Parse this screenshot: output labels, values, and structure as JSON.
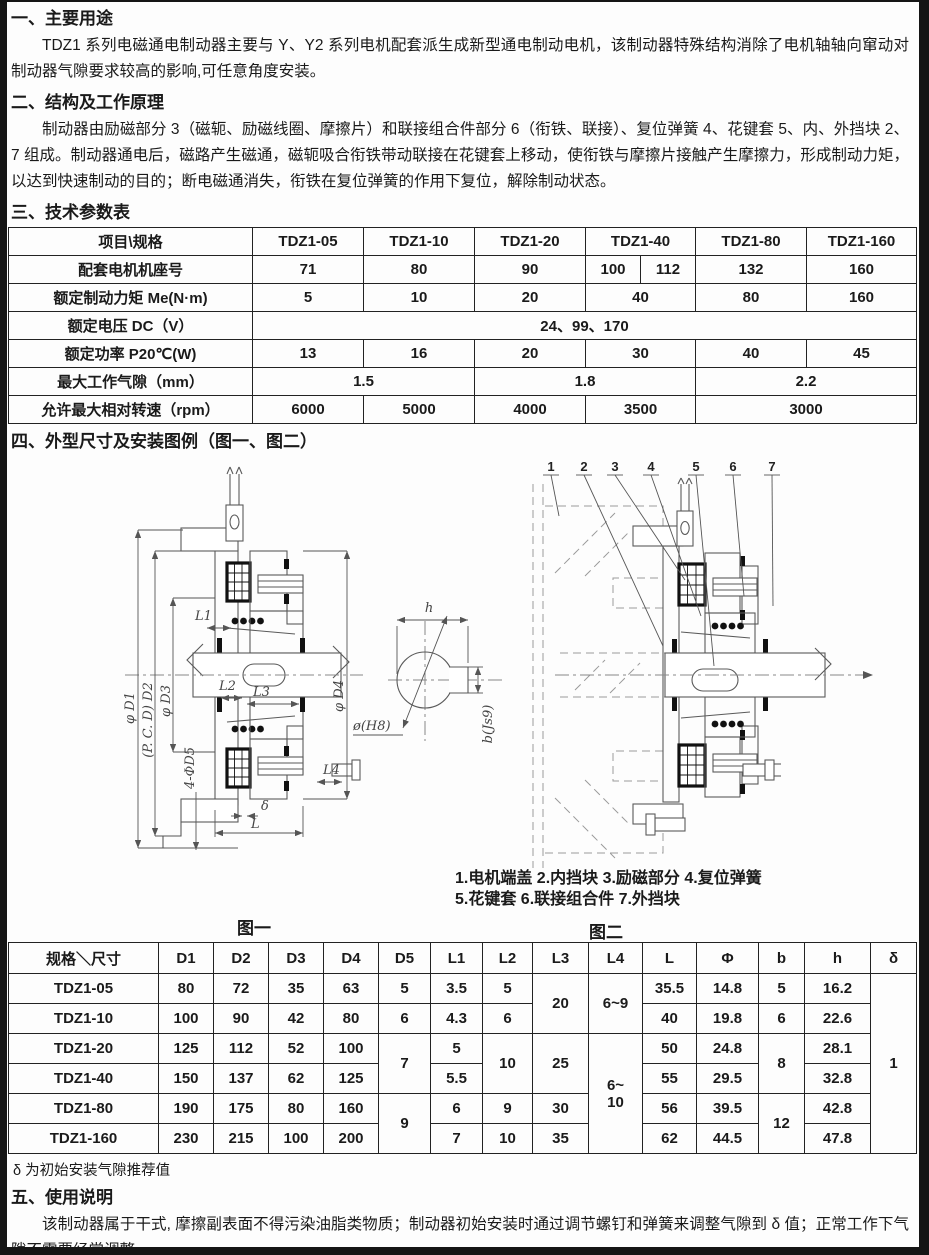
{
  "doc": {
    "s1": {
      "heading": "一、主要用途",
      "body": "TDZ1 系列电磁通电制动器主要与 Y、Y2 系列电机配套派生成新型通电制动电机，该制动器特殊结构消除了电机轴轴向窜动对制动器气隙要求较高的影响,可任意角度安装。"
    },
    "s2": {
      "heading": "二、结构及工作原理",
      "body": "制动器由励磁部分 3（磁轭、励磁线圈、摩擦片）和联接组合件部分 6（衔铁、联接）、复位弹簧 4、花键套 5、内、外挡块 2、7 组成。制动器通电后，磁路产生磁通，磁轭吸合衔铁带动联接在花键套上移动，使衔铁与摩擦片接触产生摩擦力，形成制动力矩，以达到快速制动的目的；断电磁通消失，衔铁在复位弹簧的作用下复位，解除制动状态。"
    },
    "s3": {
      "heading": "三、技术参数表"
    },
    "s4": {
      "heading": "四、外型尺寸及安装图例（图一、图二）"
    },
    "s5": {
      "heading": "五、使用说明",
      "body": "该制动器属于干式, 摩擦副表面不得污染油脂类物质；制动器初始安装时通过调节螺钉和弹簧来调整气隙到 δ 值；正常工作下气隙不需要经常调整。"
    },
    "footnote": "δ 为初始安装气隙推荐值"
  },
  "params_table": {
    "header": {
      "label": "项目\\规格",
      "cols": [
        "TDZ1-05",
        "TDZ1-10",
        "TDZ1-20",
        "TDZ1-40",
        "TDZ1-80",
        "TDZ1-160"
      ]
    },
    "motor_frame": {
      "label": "配套电机机座号",
      "values": [
        "71",
        "80",
        "90",
        "100",
        "112",
        "132",
        "160"
      ]
    },
    "torque": {
      "label": "额定制动力矩 Me(N·m)",
      "values": [
        "5",
        "10",
        "20",
        "40",
        "80",
        "160"
      ]
    },
    "voltage": {
      "label": "额定电压 DC（V）",
      "value": "24、99、170"
    },
    "power": {
      "label": "额定功率 P20℃(W)",
      "values": [
        "13",
        "16",
        "20",
        "30",
        "40",
        "45"
      ]
    },
    "gap": {
      "label": "最大工作气隙（mm）",
      "values": [
        "1.5",
        "1.8",
        "2.2"
      ]
    },
    "speed": {
      "label": "允许最大相对转速（rpm）",
      "values": [
        "6000",
        "5000",
        "4000",
        "3500",
        "3000"
      ]
    }
  },
  "dims_table": {
    "header": [
      "规格＼尺寸",
      "D1",
      "D2",
      "D3",
      "D4",
      "D5",
      "L1",
      "L2",
      "L3",
      "L4",
      "L",
      "Φ",
      "b",
      "h",
      "δ"
    ],
    "rows": [
      {
        "model": "TDZ1-05",
        "d1": "80",
        "d2": "72",
        "d3": "35",
        "d4": "63",
        "d5": "5",
        "l1": "3.5",
        "l2": "5",
        "l3": "20",
        "l4": "6~9",
        "l": "35.5",
        "phi": "14.8",
        "b": "5",
        "h": "16.2",
        "delta": "1"
      },
      {
        "model": "TDZ1-10",
        "d1": "100",
        "d2": "90",
        "d3": "42",
        "d4": "80",
        "d5": "6",
        "l1": "4.3",
        "l2": "6",
        "l": "40",
        "phi": "19.8",
        "b": "6",
        "h": "22.6"
      },
      {
        "model": "TDZ1-20",
        "d1": "125",
        "d2": "112",
        "d3": "52",
        "d4": "100",
        "d5": "7",
        "l1": "5",
        "l2": "10",
        "l3": "25",
        "l4": "6~\n10",
        "l": "50",
        "phi": "24.8",
        "b": "8",
        "h": "28.1"
      },
      {
        "model": "TDZ1-40",
        "d1": "150",
        "d2": "137",
        "d3": "62",
        "d4": "125",
        "l1": "5.5",
        "l": "55",
        "phi": "29.5",
        "h": "32.8"
      },
      {
        "model": "TDZ1-80",
        "d1": "190",
        "d2": "175",
        "d3": "80",
        "d4": "160",
        "d5": "9",
        "l1": "6",
        "l2": "9",
        "l3": "30",
        "l": "56",
        "phi": "39.5",
        "b": "12",
        "h": "42.8"
      },
      {
        "model": "TDZ1-160",
        "d1": "230",
        "d2": "215",
        "d3": "100",
        "d4": "200",
        "l1": "7",
        "l2": "10",
        "l3": "35",
        "l": "62",
        "phi": "44.5",
        "h": "47.8"
      }
    ]
  },
  "figure1": {
    "label": "图一",
    "dims": {
      "d1": "φ D1",
      "d2": "(P. C. D) D2",
      "d3": "φ D3",
      "d5": "4-ΦD5",
      "d4": "φ D4",
      "l1": "L1",
      "l2": "L2",
      "l3": "L3",
      "l4": "L4",
      "l": "L",
      "delta": "δ",
      "h": "h",
      "bore": "ø(H8)",
      "key": "b(Js9)"
    }
  },
  "figure2": {
    "label": "图二",
    "callouts": [
      "1",
      "2",
      "3",
      "4",
      "5",
      "6",
      "7"
    ],
    "caption1": "1.电机端盖 2.内挡块 3.励磁部分 4.复位弹簧",
    "caption2": "5.花键套 6.联接组合件 7.外挡块"
  }
}
